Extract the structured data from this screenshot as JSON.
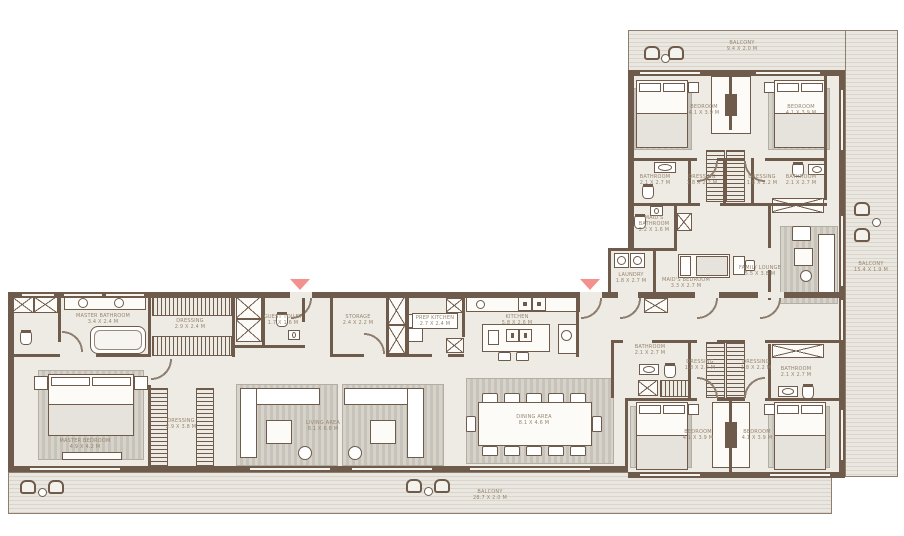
{
  "title": "Apartment floor plan",
  "colors": {
    "wall": "#6e5b4b",
    "floor": "#eeebe4",
    "balcony_stripe": "#d9d5cc",
    "entrance_arrow": "#f3918f",
    "label_text": "#97856f"
  },
  "rooms": {
    "master_bathroom": {
      "label": "Master Bathroom",
      "dims": "3.4 x 2.4 M"
    },
    "master_dressing_top": {
      "label": "Dressing",
      "dims": "2.9 x 2.4 M"
    },
    "master_bedroom": {
      "label": "Master Bedroom",
      "dims": "4.9 x 4.2 M"
    },
    "master_dressing_walk": {
      "label": "Dressing",
      "dims": "2.9 x 3.8 M"
    },
    "guest_toilet": {
      "label": "Guest Toilet",
      "dims": "1.7 x 1.6 M"
    },
    "storage": {
      "label": "Storage",
      "dims": "2.4 x 2.2 M"
    },
    "prep_kitchen": {
      "label": "Prep Kitchen",
      "dims": "2.7 x 2.4 M"
    },
    "living_area": {
      "label": "Living Area",
      "dims": "8.1 x 6.8 M"
    },
    "kitchen": {
      "label": "Kitchen",
      "dims": "5.8 x 2.6 M"
    },
    "dining_area": {
      "label": "Dining Area",
      "dims": "8.1 x 4.6 M"
    },
    "laundry": {
      "label": "Laundry",
      "dims": "1.8 x 2.7 M"
    },
    "maids_bathroom": {
      "label": "Maid's Bathroom",
      "dims": "2.2 x 1.6 M"
    },
    "maids_bedroom": {
      "label": "Maid's Bedroom",
      "dims": "3.3 x 2.7 M"
    },
    "family_lounge": {
      "label": "Family Lounge",
      "dims": "5.5 x 3.8 M"
    },
    "bedroom_tl": {
      "label": "Bedroom",
      "dims": "4.1 x 3.9 M"
    },
    "bedroom_tr": {
      "label": "Bedroom",
      "dims": "4.1 x 3.9 M"
    },
    "bedroom_bl": {
      "label": "Bedroom",
      "dims": "4.1 x 3.9 M"
    },
    "bedroom_br": {
      "label": "Bedroom",
      "dims": "4.1 x 3.9 M"
    },
    "bathroom_tl": {
      "label": "Bathroom",
      "dims": "2.1 x 2.7 M"
    },
    "bathroom_tr": {
      "label": "Bathroom",
      "dims": "2.1 x 2.7 M"
    },
    "bathroom_bl": {
      "label": "Bathroom",
      "dims": "2.1 x 2.7 M"
    },
    "bathroom_br": {
      "label": "Bathroom",
      "dims": "2.1 x 2.7 M"
    },
    "dressing_ul": {
      "label": "Dressing",
      "dims": "1.8 x 2.2 M"
    },
    "dressing_ur": {
      "label": "Dressing",
      "dims": "1.8 x 2.2 M"
    },
    "dressing_ll": {
      "label": "Dressing",
      "dims": "1.8 x 2.2 M"
    },
    "dressing_lr": {
      "label": "Dressing",
      "dims": "1.8 x 2.2 M"
    },
    "balcony_top": {
      "label": "Balcony",
      "dims": "9.4 x 2.0 M"
    },
    "balcony_right": {
      "label": "Balcony",
      "dims": "15.4 x 1.9 M"
    },
    "balcony_bottom": {
      "label": "Balcony",
      "dims": "28.7 x 2.0 M"
    }
  }
}
